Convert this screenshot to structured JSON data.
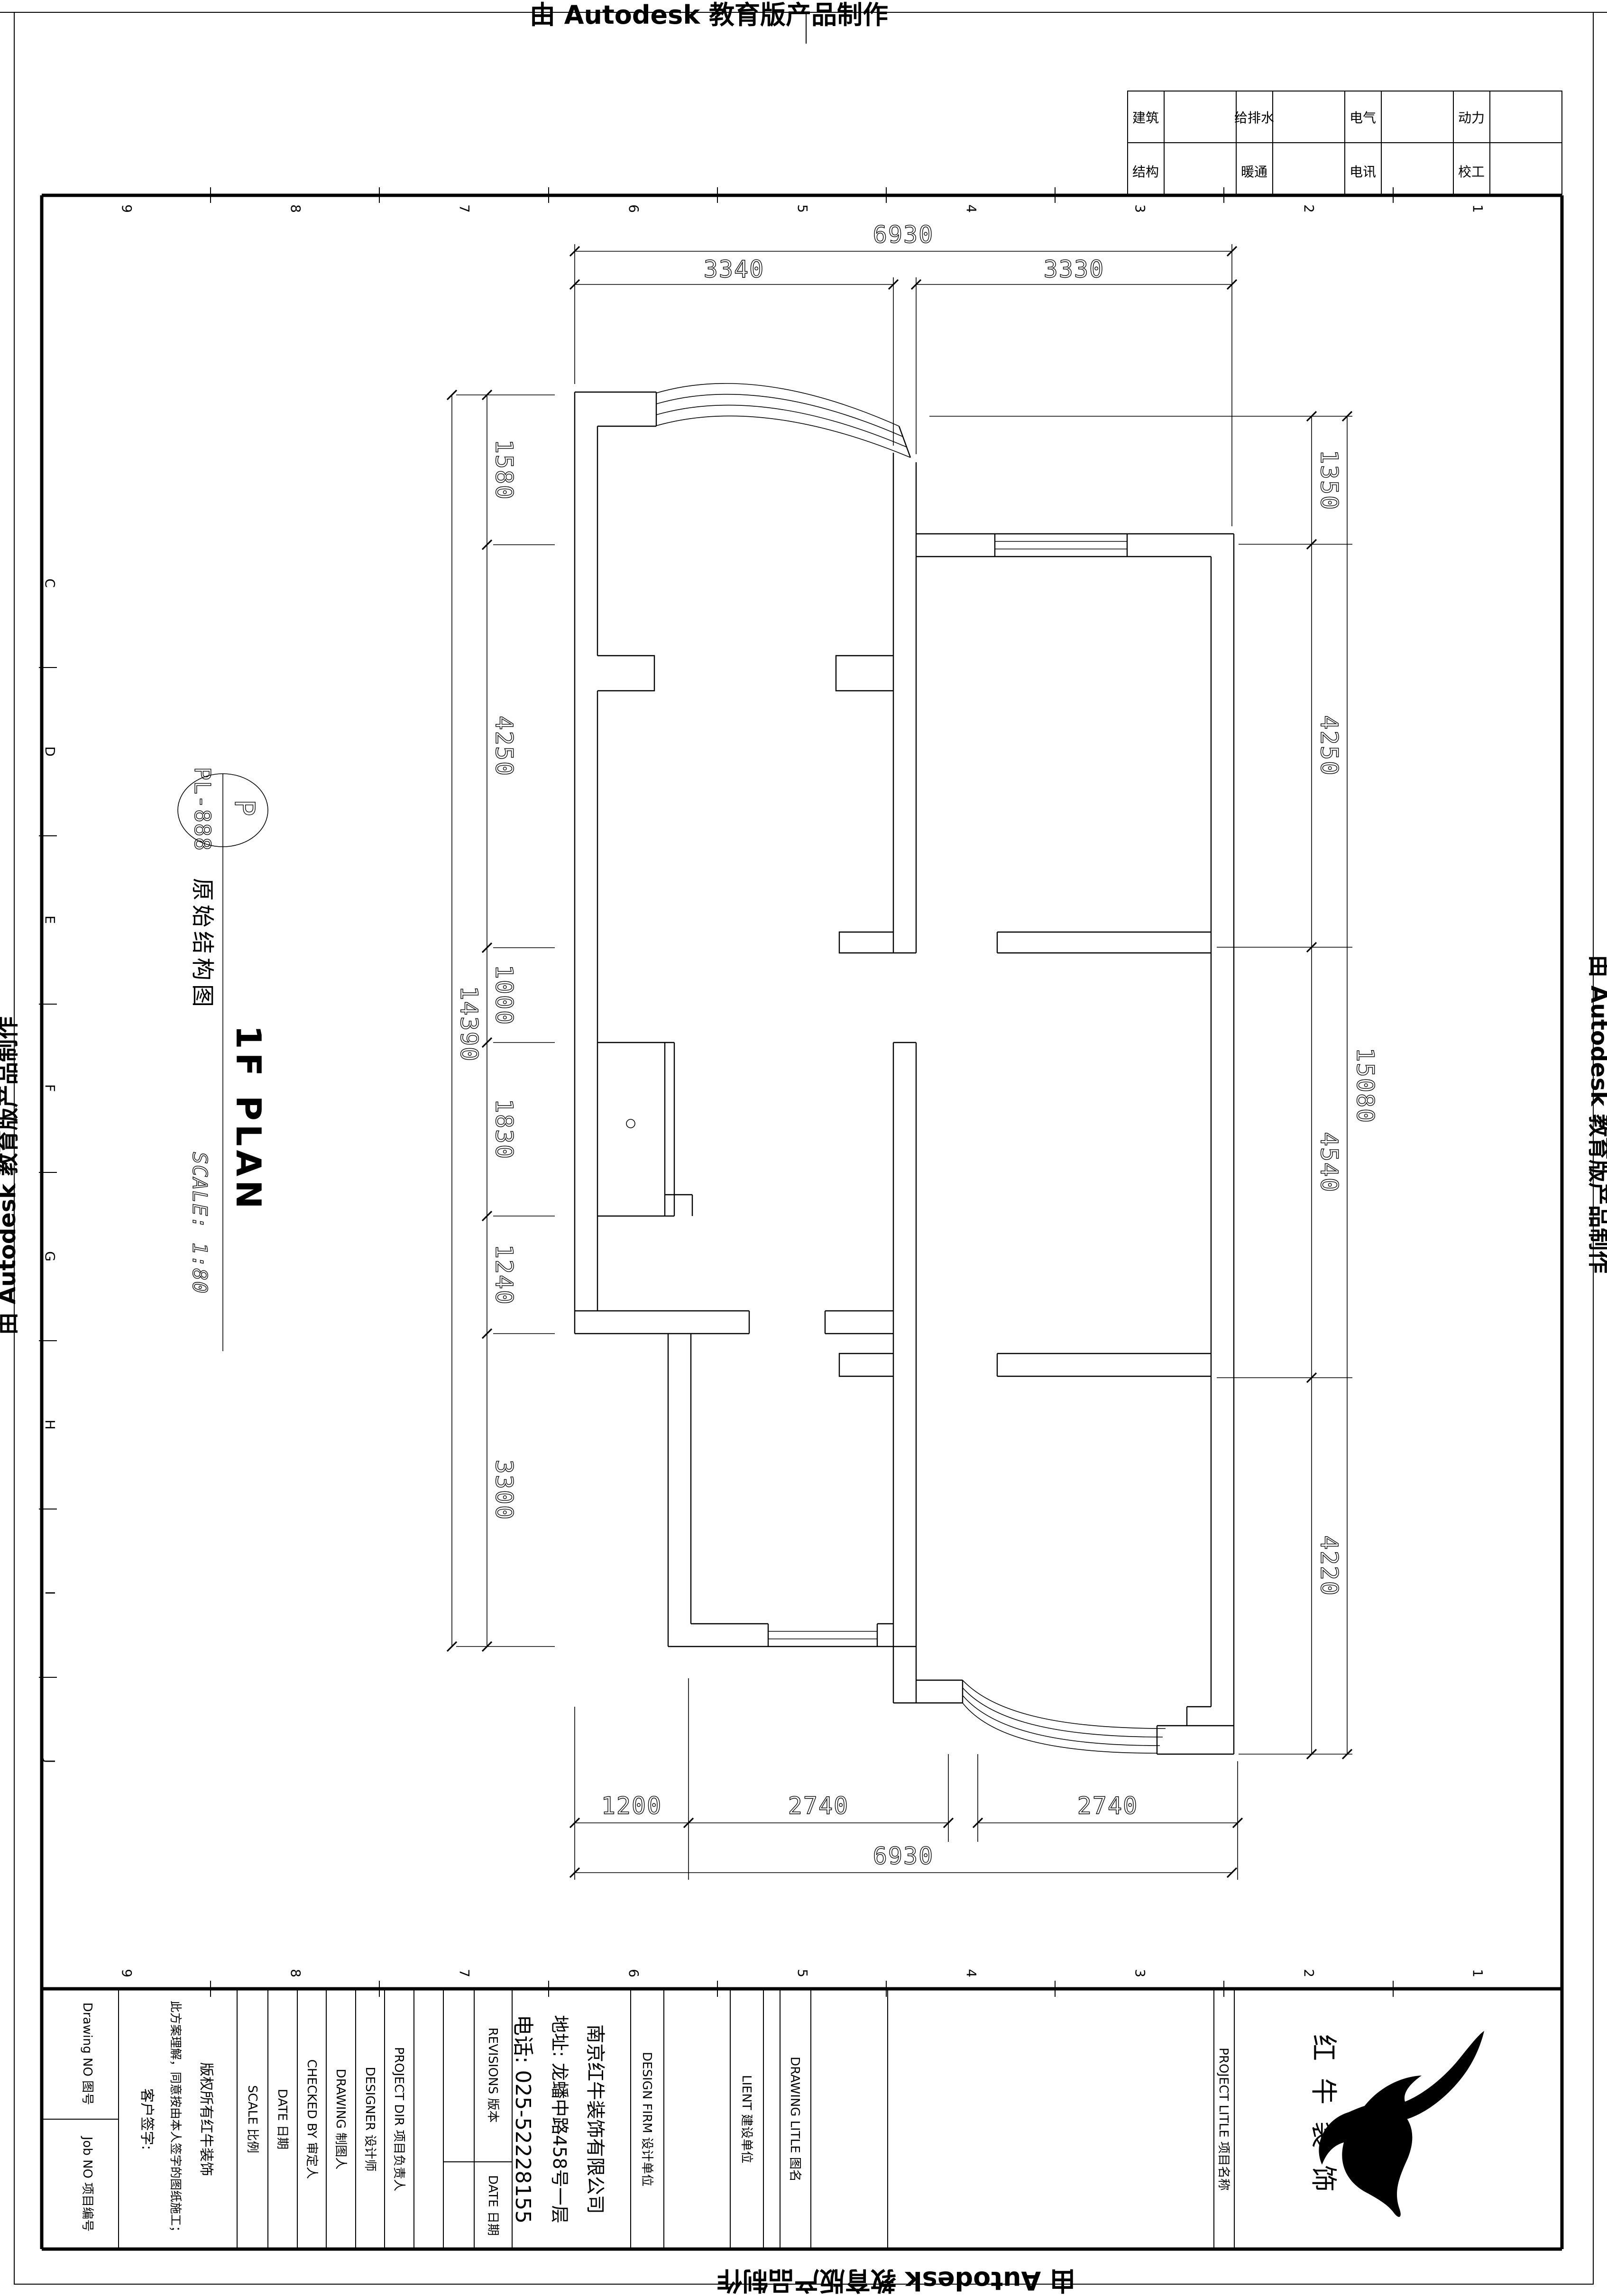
{
  "stamp": {
    "text": "由 Autodesk 教育版产品制作"
  },
  "sheet": {
    "table": {
      "rows": [
        [
          "建筑",
          "给排水",
          "电气",
          "动力"
        ],
        [
          "结构",
          "暖通",
          "电讯",
          "校工"
        ]
      ]
    },
    "grid_numbers": [
      "9",
      "8",
      "7",
      "6",
      "5",
      "4",
      "3",
      "2",
      "1"
    ],
    "grid_letters": [
      "C",
      "D",
      "E",
      "F",
      "G",
      "H",
      "I",
      "J"
    ]
  },
  "drawing": {
    "tag": {
      "letter": "P",
      "code": "PL-888"
    },
    "title_cn": "原始结构图",
    "title_en": "1F PLAN",
    "scale_label": "SCALE: 1:80",
    "dims": {
      "top": {
        "overall": "6930",
        "segments": [
          "3340",
          "3330"
        ]
      },
      "bottom": {
        "overall": "6930",
        "segments": [
          "1200",
          "2740",
          "2740"
        ]
      },
      "left": {
        "overall": "14390",
        "segments": [
          "1580",
          "4250",
          "1000",
          "1830",
          "1240",
          "3300"
        ]
      },
      "right": {
        "overall": "15080",
        "segments": [
          "1350",
          "4250",
          "4540",
          "4220"
        ]
      }
    }
  },
  "titleblock": {
    "drawing_no": "Drawing NO 图号",
    "job_no": "Job NO 项目编号",
    "disclaimer": [
      "版权所有红牛装饰",
      "此方案理解，同意按由本人签字的图纸施工；",
      "客户签字:"
    ],
    "scale": "SCALE 比例",
    "date": "DATE 日期",
    "checked": "CHECKED BY 审定人",
    "drawing": "DRAWING 制图人",
    "designer": "DESIGNER 设计师",
    "project_dir": "PROJECT DIR 项目负责人",
    "revisions": "REVISIONS 版本",
    "rev_date": "DATE 日期",
    "company": {
      "name": "南京红牛装饰有限公司",
      "address": "地址: 龙蟠中路458号一层",
      "phone": "电话: 025-52228155"
    },
    "design_firm": "DESIGN FIRM 设计单位",
    "client": "LIENT 建设单位",
    "drawing_title": "DRAWING LITLE 图名",
    "project_title": "PROJECT LITLE 项目名称",
    "logo_text": "红牛装饰"
  }
}
